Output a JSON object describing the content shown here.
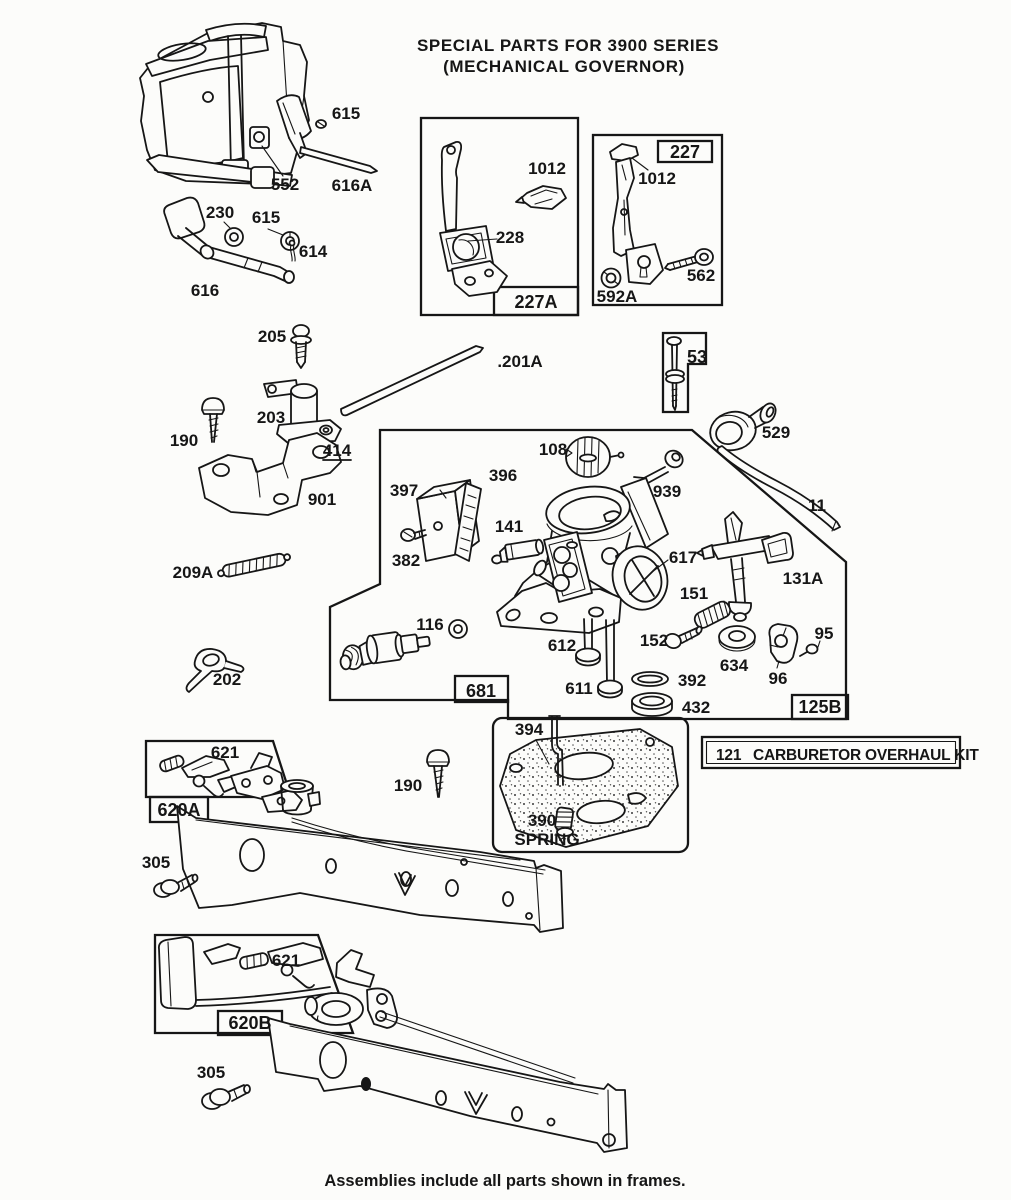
{
  "title": {
    "line1": "SPECIAL PARTS FOR 3900 SERIES",
    "line2": "(MECHANICAL GOVERNOR)"
  },
  "footer": "Assemblies include all parts shown in frames.",
  "overhaul_kit": {
    "number": "121",
    "label": "CARBURETOR OVERHAUL KIT"
  },
  "frames": {
    "f227a": "227A",
    "f227": "227",
    "f53": "53",
    "f681": "681",
    "f125b": "125B",
    "f620a": "620A",
    "f620b": "620B"
  },
  "annotations": {
    "spring": "SPRING"
  },
  "parts": {
    "p615_engine": "615",
    "p552": "552",
    "p616a": "616A",
    "p230": "230",
    "p615_washer": "615",
    "p614": "614",
    "p616": "616",
    "p1012_227a": "1012",
    "p228": "228",
    "p1012_227": "1012",
    "p562": "562",
    "p592a": "592A",
    "p205": "205",
    "p201a": ".201A",
    "p203": "203",
    "p190_top": "190",
    "p414": "414",
    "p901": "901",
    "p529": "529",
    "p108": "108",
    "p396": "396",
    "p397": "397",
    "p939": "939",
    "p11": "11",
    "p141": "141",
    "p382": "382",
    "p617": "617",
    "p131a": "131A",
    "p209a": "209A",
    "p151": "151",
    "p116": "116",
    "p152": "152",
    "p95": "95",
    "p634": "634",
    "p202": "202",
    "p96": "96",
    "p612": "612",
    "p611": "611",
    "p392": "392",
    "p432": "432",
    "p394": "394",
    "p390": "390",
    "p621_a": "621",
    "p190_mid": "190",
    "p305_a": "305",
    "p621_b": "621",
    "p305_b": "305"
  }
}
